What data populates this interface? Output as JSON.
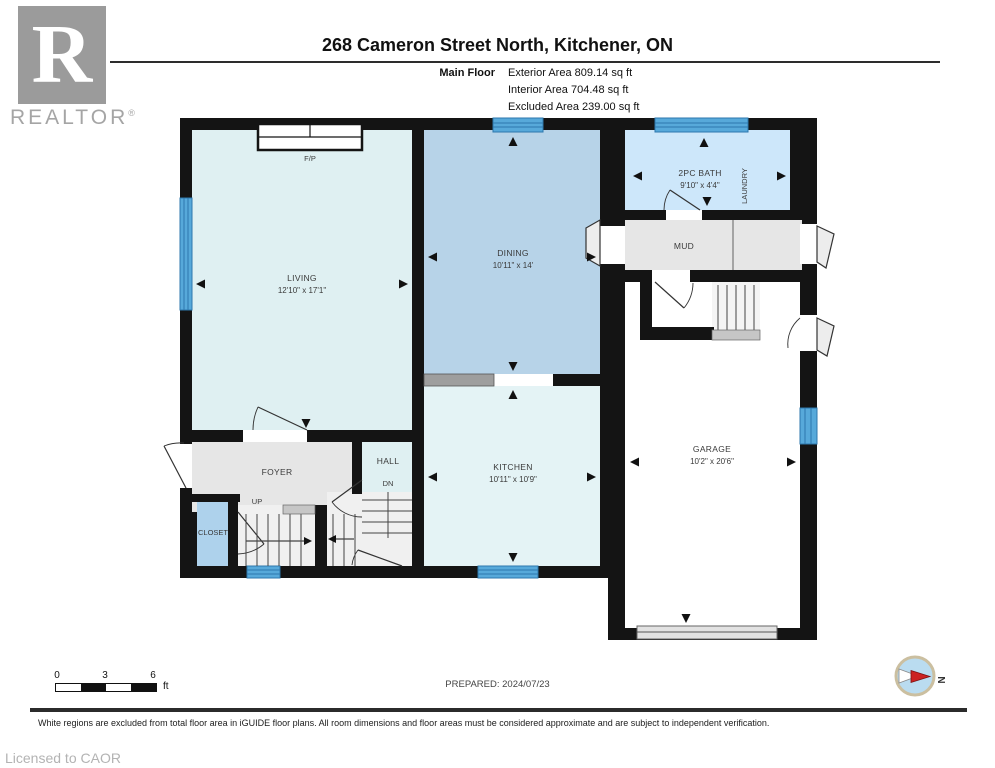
{
  "header": {
    "logo_letter": "R",
    "logo_text": "REALTOR",
    "logo_registered": "®",
    "title": "268 Cameron Street North, Kitchener, ON",
    "floor_label": "Main Floor",
    "areas": [
      {
        "label": "Exterior Area",
        "value": "809.14 sq ft"
      },
      {
        "label": "Interior Area",
        "value": "704.48 sq ft"
      },
      {
        "label": "Excluded Area",
        "value": "239.00 sq ft"
      }
    ]
  },
  "plan": {
    "rooms": {
      "living": {
        "name": "LIVING",
        "dims": "12'10\" x 17'1\""
      },
      "dining": {
        "name": "DINING",
        "dims": "10'11\" x 14'"
      },
      "kitchen": {
        "name": "KITCHEN",
        "dims": "10'11\" x 10'9\""
      },
      "bath": {
        "name": "2PC BATH",
        "dims": "9'10\" x 4'4\""
      },
      "laundry": {
        "name": "LAUNDRY"
      },
      "mud": {
        "name": "MUD"
      },
      "garage": {
        "name": "GARAGE",
        "dims": "10'2\" x 20'6\""
      },
      "foyer": {
        "name": "FOYER"
      },
      "hall": {
        "name": "HALL"
      },
      "closet": {
        "name": "CLOSET"
      }
    },
    "annotations": {
      "fireplace": "F/P",
      "up": "UP",
      "down": "DN"
    },
    "colors": {
      "wall": "#141414",
      "included_room": "#dff0f2",
      "dining_blue": "#b7d3e8",
      "bath_blue": "#cde7fa",
      "closet_blue": "#aed2ec",
      "window_blue": "#57a9da",
      "window_stripe": "#2d77ad",
      "excluded_gray": "#e6e6e6",
      "garage_white": "#ffffff"
    }
  },
  "scale_bar": {
    "tick0": "0",
    "tick3": "3",
    "tick6": "6",
    "unit": "ft"
  },
  "prepared": "PREPARED: 2024/07/23",
  "compass": {
    "north_label": "N"
  },
  "footer": {
    "disclaimer": "White regions are excluded from total floor area in iGUIDE floor plans. All room dimensions and floor areas must be considered approximate and are subject to independent verification.",
    "license": "Licensed to CAOR"
  }
}
